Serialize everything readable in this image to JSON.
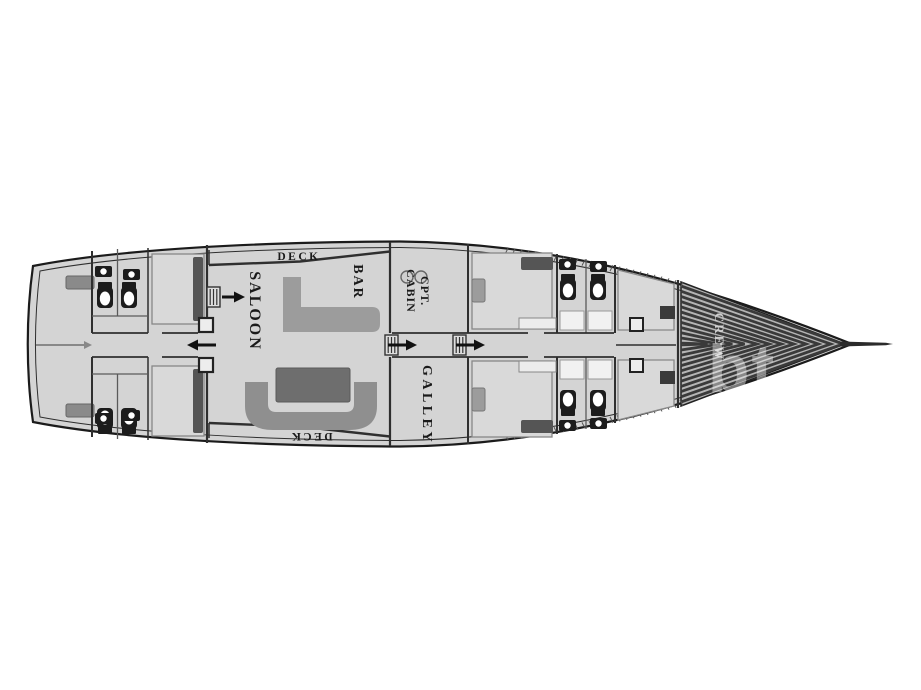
{
  "plan": {
    "title": "yacht-deck-plan",
    "labels": {
      "deck_top": "DECK",
      "deck_bottom": "DECK",
      "saloon": "SALOON",
      "bar": "BAR",
      "captain_cabin_line1": "CPT.",
      "captain_cabin_line2": "CABIN",
      "galley": "GALLEY",
      "crew": "CREW",
      "watermark": "bt"
    },
    "icons": {
      "toilet": "toilet-icon",
      "sink": "sink-icon",
      "companionway_stairs": "stairs-icon",
      "direction_arrow": "arrow-icon",
      "bed": "bed",
      "pillow": "pillow",
      "bar_counter": "bar-counter",
      "sofa": "u-sofa",
      "table": "saloon-table",
      "bowsprit": "bowsprit"
    },
    "colors": {
      "background": "#ffffff",
      "hull_fill": "#d4d4d4",
      "hull_outline": "#1b1b1b",
      "inner_line": "#2e2e2e",
      "wall": "#2f2f2f",
      "bed_fill": "#d9d9d9",
      "pillow": "#555555",
      "furniture_mid": "#9c9c9c",
      "sofa": "#8f8f8f",
      "table": "#6e6e6e",
      "fixture_dark": "#1c1c1c",
      "stripe_dark": "#3a3a3a",
      "stripe_bg": "#b5b5b5",
      "tick": "#555555",
      "label_text": "#1a1a1a",
      "crew_text": "#d4d4d4"
    }
  }
}
